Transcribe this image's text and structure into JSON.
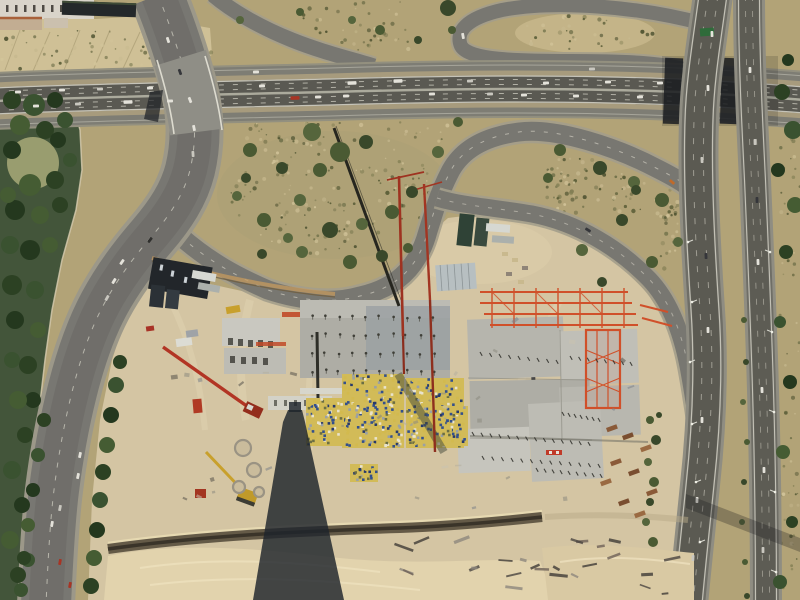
{
  "meta": {
    "subject": "aerial photograph of motorway interchange beside large construction site",
    "width": 800,
    "height": 600
  },
  "palette": {
    "scrub_base": "#b2a377",
    "scrub_light": "#c3b388",
    "cut_earth": "#cfc096",
    "sand": "#d4c5a3",
    "sand_light": "#e2d3ad",
    "park_green": "#43553a",
    "lawn": "#a3a575",
    "road_shoulder": "#93907f",
    "road_surface": "#7e7d74",
    "road_dark": "#5a5952",
    "lane_line": "#d8d6ca",
    "bridge_shadow": "#1b1d21",
    "concrete": "#b6b5ad",
    "concrete_light": "#c9c8c0",
    "steel_orange": "#d0502a",
    "crane_red": "#9e3220",
    "formwork_yellow": "#d2bb58",
    "formwork_blue": "#34508c",
    "trench_brown": "#5e5442",
    "tower_shadow": "#1f242c",
    "sign_green": "#2f6b3a",
    "scrub_speckles": [
      "#6d6e47",
      "#545833",
      "#837f55",
      "#4a4f2e",
      "#c7b98f",
      "#d2c49a"
    ],
    "tree_greens": [
      "#2c4123",
      "#3a5230",
      "#24381e",
      "#455c33"
    ],
    "bush_greens": [
      "#4a5a33",
      "#39482a",
      "#55653c"
    ],
    "vehicle_colors": [
      "#e4e2da",
      "#c9c7bf",
      "#35363a",
      "#a83424",
      "#c06a2a",
      "#2f2f2d"
    ]
  },
  "vehicles": {
    "ew_upper": [
      [
        18,
        92,
        -2,
        0
      ],
      [
        62,
        90,
        -2,
        0
      ],
      [
        100,
        89,
        -2,
        1
      ],
      [
        150,
        88,
        -2,
        0
      ],
      [
        262,
        86,
        -2,
        0
      ],
      [
        352,
        83,
        -2,
        0,
        9
      ],
      [
        398,
        81,
        -2,
        0,
        9
      ],
      [
        470,
        81,
        -2,
        1
      ],
      [
        546,
        83,
        -2,
        0
      ],
      [
        608,
        82,
        -2,
        0
      ],
      [
        660,
        83,
        -2,
        0
      ]
    ],
    "ew_lower": [
      [
        36,
        106,
        -2,
        0
      ],
      [
        78,
        104,
        -2,
        1
      ],
      [
        128,
        102,
        -2,
        0,
        9
      ],
      [
        170,
        101,
        -2,
        0
      ],
      [
        295,
        98,
        -2,
        3,
        9
      ],
      [
        318,
        97,
        -2,
        0
      ],
      [
        346,
        96,
        -2,
        0
      ],
      [
        432,
        94,
        -2,
        0
      ],
      [
        490,
        94,
        -2,
        1
      ],
      [
        524,
        95,
        -2,
        0
      ],
      [
        576,
        96,
        -2,
        0
      ],
      [
        640,
        97,
        -2,
        0
      ]
    ],
    "ew_service": [
      [
        256,
        72,
        -2,
        0
      ],
      [
        592,
        69,
        -2,
        1
      ]
    ],
    "avenue": [
      [
        168,
        40,
        72,
        0
      ],
      [
        180,
        72,
        70,
        2
      ],
      [
        190,
        100,
        68,
        0
      ],
      [
        194,
        128,
        78,
        0
      ],
      [
        193,
        154,
        86,
        1
      ],
      [
        150,
        240,
        128,
        5
      ],
      [
        122,
        262,
        125,
        0
      ],
      [
        114,
        281,
        122,
        0
      ],
      [
        107,
        298,
        120,
        1
      ],
      [
        80,
        455,
        102,
        0
      ],
      [
        78,
        476,
        102,
        0
      ],
      [
        52,
        524,
        100,
        0
      ],
      [
        60,
        508,
        101,
        1
      ],
      [
        60,
        562,
        100,
        3
      ],
      [
        70,
        585,
        100,
        3
      ]
    ],
    "ns_sb": [
      [
        712,
        34,
        88,
        0
      ],
      [
        708,
        88,
        88,
        0
      ],
      [
        702,
        160,
        87,
        1
      ],
      [
        706,
        256,
        88,
        2
      ],
      [
        708,
        330,
        89,
        0
      ],
      [
        702,
        420,
        91,
        0
      ],
      [
        697,
        500,
        92,
        0
      ],
      [
        693,
        558,
        93,
        1
      ]
    ],
    "ns_nb": [
      [
        750,
        70,
        89,
        0
      ],
      [
        755,
        142,
        89,
        1
      ],
      [
        757,
        200,
        89,
        2
      ],
      [
        758,
        262,
        88,
        0
      ],
      [
        762,
        390,
        88,
        0
      ],
      [
        764,
        470,
        89,
        0
      ],
      [
        763,
        550,
        90,
        1
      ]
    ],
    "ramps": [
      [
        672,
        182,
        40,
        4
      ],
      [
        463,
        36,
        80,
        0
      ],
      [
        588,
        230,
        32,
        2
      ]
    ]
  },
  "vegetation": {
    "park_blobs": [
      [
        12,
        100,
        9
      ],
      [
        34,
        105,
        11
      ],
      [
        55,
        100,
        8
      ],
      [
        20,
        125,
        10
      ],
      [
        45,
        130,
        9
      ],
      [
        65,
        120,
        8
      ],
      [
        12,
        150,
        9
      ],
      [
        30,
        185,
        11
      ],
      [
        55,
        180,
        9
      ],
      [
        70,
        160,
        7
      ],
      [
        15,
        210,
        10
      ],
      [
        40,
        215,
        9
      ],
      [
        60,
        205,
        8
      ],
      [
        10,
        245,
        9
      ],
      [
        30,
        250,
        10
      ],
      [
        50,
        245,
        8
      ],
      [
        12,
        285,
        10
      ],
      [
        35,
        290,
        9
      ],
      [
        15,
        320,
        9
      ],
      [
        38,
        330,
        8
      ],
      [
        28,
        365,
        9
      ],
      [
        12,
        360,
        8
      ],
      [
        33,
        400,
        8
      ],
      [
        18,
        400,
        9
      ],
      [
        25,
        435,
        8
      ],
      [
        12,
        470,
        9
      ],
      [
        22,
        505,
        8
      ],
      [
        10,
        540,
        9
      ],
      [
        18,
        575,
        8
      ],
      [
        28,
        560,
        7
      ],
      [
        58,
        140,
        8
      ],
      [
        8,
        195,
        8
      ]
    ],
    "avenue_trees_right": [
      [
        120,
        362,
        7
      ],
      [
        116,
        385,
        8
      ],
      [
        111,
        415,
        8
      ],
      [
        107,
        445,
        8
      ],
      [
        103,
        472,
        8
      ],
      [
        100,
        500,
        8
      ],
      [
        97,
        530,
        8
      ],
      [
        94,
        558,
        8
      ],
      [
        91,
        586,
        8
      ]
    ],
    "avenue_trees_left": [
      [
        44,
        420,
        7
      ],
      [
        38,
        455,
        7
      ],
      [
        33,
        490,
        7
      ],
      [
        28,
        525,
        7
      ],
      [
        24,
        558,
        7
      ],
      [
        21,
        590,
        7
      ]
    ],
    "teardrop_bushes": [
      [
        250,
        150,
        7
      ],
      [
        282,
        168,
        6
      ],
      [
        312,
        132,
        9
      ],
      [
        340,
        152,
        10
      ],
      [
        366,
        142,
        7
      ],
      [
        300,
        200,
        6
      ],
      [
        264,
        220,
        7
      ],
      [
        330,
        230,
        8
      ],
      [
        362,
        224,
        6
      ],
      [
        392,
        212,
        7
      ],
      [
        412,
        192,
        6
      ],
      [
        302,
        252,
        6
      ],
      [
        350,
        262,
        7
      ],
      [
        262,
        254,
        5
      ],
      [
        237,
        196,
        5
      ],
      [
        408,
        248,
        5
      ],
      [
        382,
        256,
        6
      ],
      [
        438,
        152,
        6
      ],
      [
        458,
        122,
        5
      ],
      [
        246,
        178,
        5
      ],
      [
        288,
        238,
        5
      ],
      [
        320,
        170,
        7
      ]
    ],
    "right_strip_bushes": [
      [
        560,
        150,
        6
      ],
      [
        600,
        168,
        7
      ],
      [
        634,
        182,
        6
      ],
      [
        662,
        200,
        7
      ],
      [
        622,
        220,
        6
      ],
      [
        582,
        250,
        6
      ],
      [
        652,
        262,
        6
      ],
      [
        602,
        282,
        5
      ],
      [
        678,
        242,
        5
      ],
      [
        548,
        178,
        5
      ],
      [
        636,
        190,
        5
      ]
    ],
    "top_bushes": [
      [
        380,
        30,
        5
      ],
      [
        418,
        40,
        4
      ],
      [
        352,
        20,
        4
      ],
      [
        452,
        30,
        4
      ],
      [
        448,
        8,
        8
      ],
      [
        240,
        20,
        4
      ],
      [
        300,
        12,
        4
      ]
    ],
    "right_edge_trees": [
      [
        782,
        92,
        8
      ],
      [
        793,
        130,
        9
      ],
      [
        778,
        170,
        7
      ],
      [
        795,
        205,
        8
      ],
      [
        786,
        252,
        7
      ],
      [
        780,
        322,
        6
      ],
      [
        790,
        382,
        7
      ],
      [
        783,
        452,
        7
      ],
      [
        792,
        522,
        6
      ],
      [
        780,
        582,
        7
      ],
      [
        788,
        60,
        6
      ]
    ],
    "median_bushes": [
      [
        744,
        320,
        3
      ],
      [
        746,
        362,
        3
      ],
      [
        743,
        402,
        3
      ],
      [
        747,
        442,
        3
      ],
      [
        744,
        482,
        3
      ],
      [
        742,
        522,
        3
      ],
      [
        745,
        562,
        3
      ],
      [
        747,
        596,
        3
      ]
    ],
    "ramp_shrubs": [
      [
        650,
        420,
        4
      ],
      [
        656,
        440,
        5
      ],
      [
        648,
        462,
        4
      ],
      [
        654,
        482,
        5
      ],
      [
        650,
        502,
        4
      ],
      [
        646,
        522,
        4
      ],
      [
        653,
        542,
        5
      ],
      [
        659,
        415,
        3
      ]
    ]
  },
  "texture": {
    "scrub_zones": [
      {
        "t": "r",
        "x": 0,
        "y": 30,
        "w": 212,
        "h": 40,
        "n": 70
      },
      {
        "t": "r",
        "x": 300,
        "y": 2,
        "w": 110,
        "h": 48,
        "n": 50
      },
      {
        "t": "e",
        "cx": 335,
        "cy": 195,
        "rx": 105,
        "ry": 60,
        "n": 150
      },
      {
        "t": "r",
        "x": 240,
        "y": 122,
        "w": 225,
        "h": 20,
        "n": 40
      },
      {
        "t": "r",
        "x": 545,
        "y": 158,
        "w": 60,
        "h": 28,
        "n": 30
      },
      {
        "t": "r",
        "x": 612,
        "y": 168,
        "w": 66,
        "h": 46,
        "n": 40
      },
      {
        "t": "e",
        "cx": 572,
        "cy": 196,
        "rx": 34,
        "ry": 18,
        "n": 30
      },
      {
        "t": "e",
        "cx": 585,
        "cy": 33,
        "rx": 70,
        "ry": 18,
        "n": 35
      },
      {
        "t": "r",
        "x": 780,
        "y": 40,
        "w": 20,
        "h": 555,
        "n": 70
      },
      {
        "t": "r",
        "x": 660,
        "y": 200,
        "w": 18,
        "h": 70,
        "n": 25
      }
    ],
    "site_scatter": {
      "x": 170,
      "y": 315,
      "w": 470,
      "h": 195,
      "n": 34
    },
    "debris_zone": {
      "x": 375,
      "y": 538,
      "w": 312,
      "h": 56,
      "n": 26
    }
  },
  "construction": {
    "checker_decks": [
      {
        "x": 342,
        "y": 374,
        "w": 62,
        "h": 74
      },
      {
        "x": 406,
        "y": 378,
        "w": 58,
        "h": 70
      },
      {
        "x": 432,
        "y": 406,
        "w": 36,
        "h": 40
      },
      {
        "x": 306,
        "y": 398,
        "w": 38,
        "h": 48
      },
      {
        "x": 350,
        "y": 464,
        "w": 28,
        "h": 18
      }
    ],
    "column_grid": {
      "x0": 312,
      "y0": 317,
      "cols": 10,
      "rows": 4,
      "dx": 13.5,
      "dy": 18
    },
    "tick_rows": [
      [
        472,
        432,
        588,
        442,
        14
      ],
      [
        482,
        456,
        598,
        464,
        13
      ],
      [
        562,
        412,
        598,
        418,
        7
      ],
      [
        536,
        468,
        600,
        474,
        9
      ],
      [
        480,
        352,
        556,
        360,
        9
      ],
      [
        570,
        356,
        630,
        362,
        8
      ]
    ],
    "material_piles": [
      [
        606,
        428
      ],
      [
        622,
        436
      ],
      [
        640,
        448
      ],
      [
        610,
        462
      ],
      [
        628,
        472
      ],
      [
        600,
        482
      ],
      [
        646,
        492
      ],
      [
        618,
        502
      ],
      [
        634,
        514
      ]
    ],
    "ring_forms": [
      [
        243,
        448,
        8
      ],
      [
        254,
        470,
        7
      ],
      [
        239,
        487,
        6
      ],
      [
        259,
        492,
        5
      ]
    ],
    "lamp_posts_west": [
      [
        688,
        242
      ],
      [
        692,
        302
      ],
      [
        690,
        362
      ],
      [
        692,
        424
      ],
      [
        696,
        482
      ],
      [
        700,
        542
      ]
    ],
    "lamp_posts_east": [
      [
        770,
        252
      ],
      [
        772,
        332
      ],
      [
        774,
        412
      ],
      [
        775,
        492
      ],
      [
        776,
        572
      ]
    ]
  }
}
